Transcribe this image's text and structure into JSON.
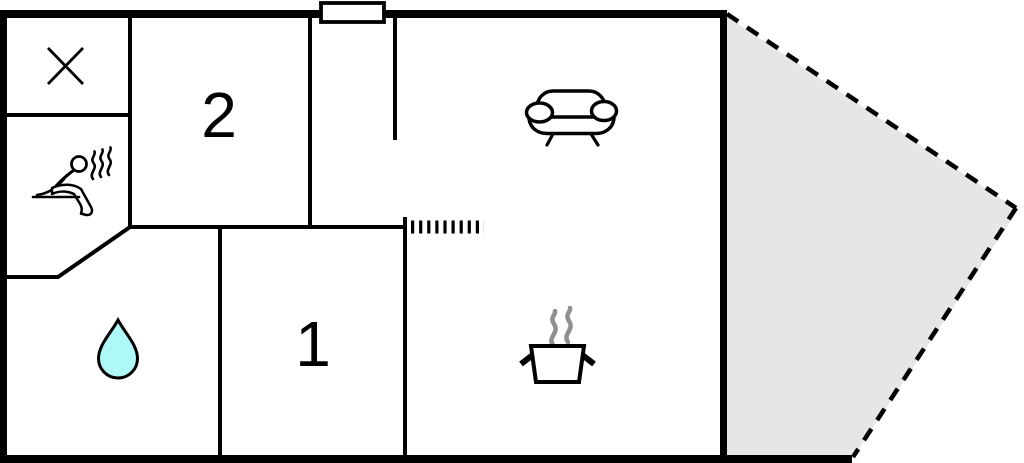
{
  "floor_plan": {
    "labels": {
      "room_2": "2",
      "room_1": "1"
    },
    "icons": [
      "x-icon",
      "sauna-person-icon",
      "sauna-steam-icon",
      "water-drop-icon",
      "sofa-icon",
      "cooking-pot-icon",
      "pot-steam-icon",
      "chimney",
      "stairs-hatch-icon",
      "terrace-dashed-outline"
    ],
    "colors": {
      "wall": "#000000",
      "floor": "#ffffff",
      "terrace_fill": "#e6e6e6",
      "water_drop_fill": "#aef8f8",
      "pot_steam_gray": "#8f8f8f"
    }
  }
}
